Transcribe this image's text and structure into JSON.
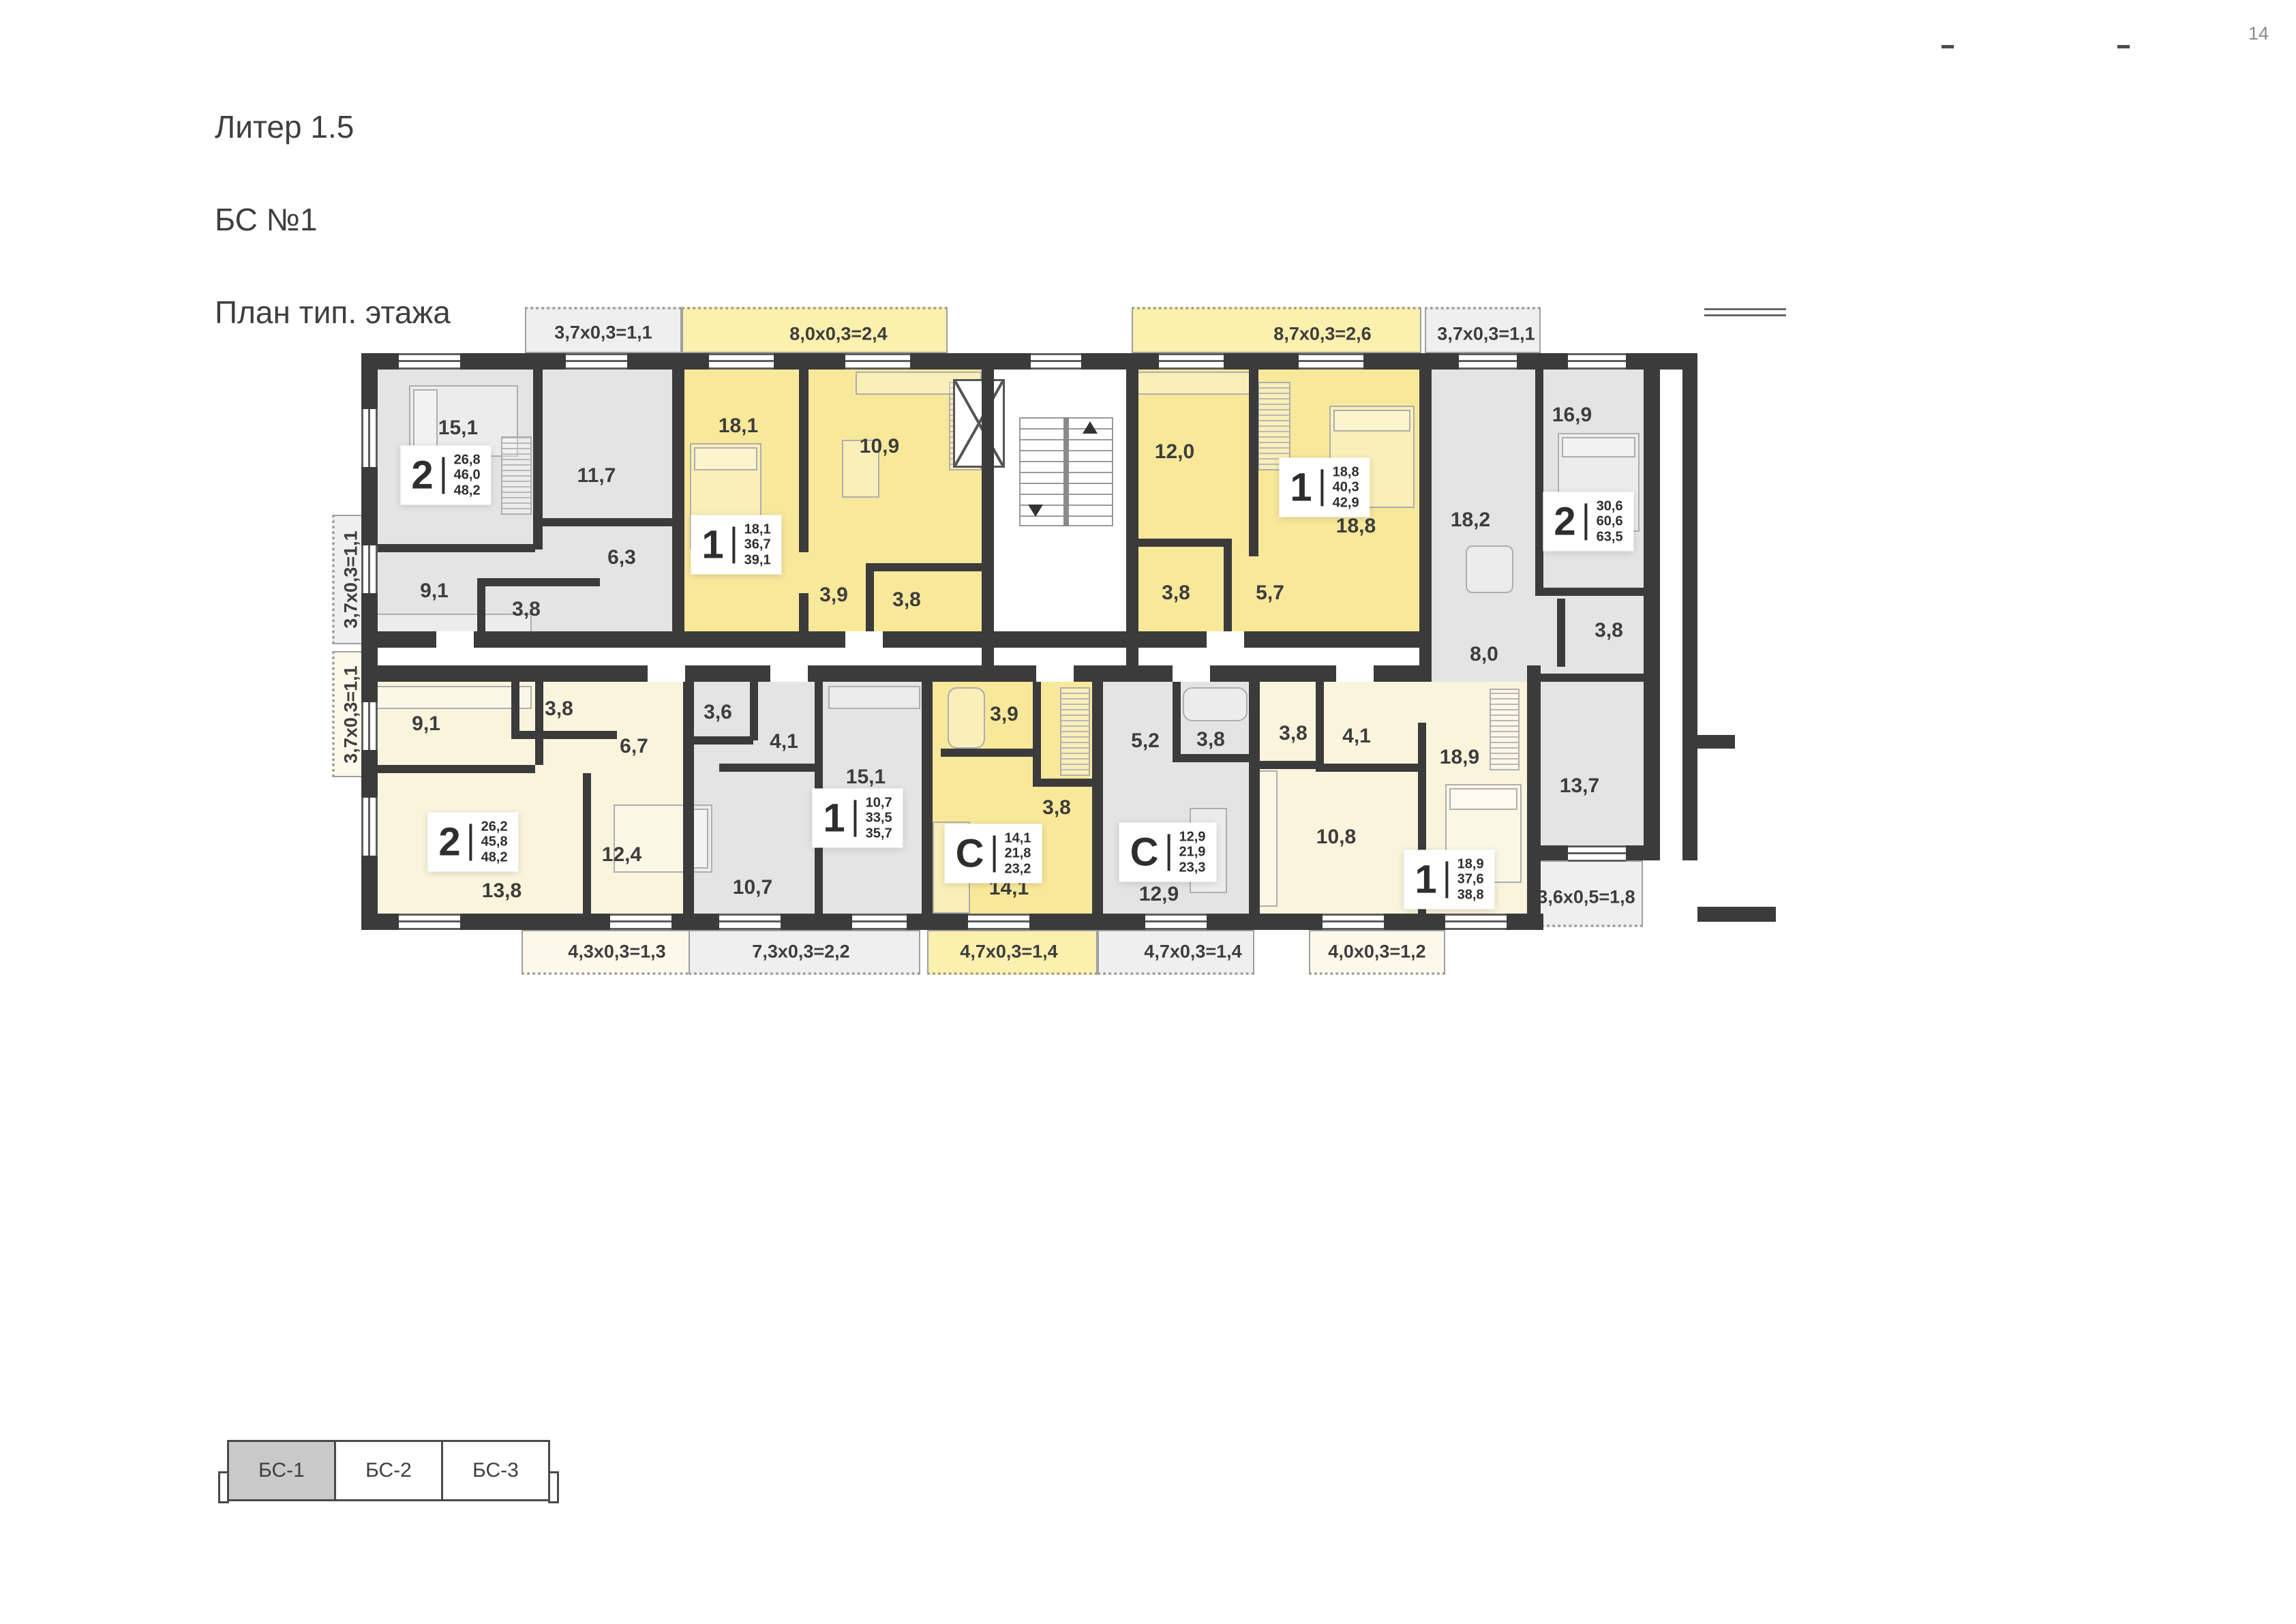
{
  "header": {
    "title_lines": [
      "Литер 1.5",
      "БС №1",
      "План тип. этажа"
    ],
    "page_number": "14"
  },
  "colors": {
    "wall": "#3b3b3b",
    "room_gray": "#e4e4e4",
    "room_yellow": "#f8e89a",
    "room_cream": "#faf4dd",
    "tab_selected": "#c9c9c9"
  },
  "apartments": [
    {
      "id": "A1",
      "type": "2",
      "areas": [
        "26,8",
        "46,0",
        "48,2"
      ],
      "rooms": [
        {
          "area": "15,1"
        },
        {
          "area": "11,7"
        },
        {
          "area": "6,3"
        },
        {
          "area": "9,1"
        },
        {
          "area": "3,8"
        }
      ],
      "balconies": [
        {
          "label": "3,7x0,3=1,1"
        },
        {
          "label": "3,7x0,3=1,1"
        }
      ]
    },
    {
      "id": "A2",
      "type": "1",
      "areas": [
        "18,1",
        "36,7",
        "39,1"
      ],
      "rooms": [
        {
          "area": "18,1"
        },
        {
          "area": "10,9"
        },
        {
          "area": "3,9"
        },
        {
          "area": "3,8"
        }
      ],
      "balconies": [
        {
          "label": "8,0x0,3=2,4"
        }
      ]
    },
    {
      "id": "A3",
      "type": "1",
      "areas": [
        "18,8",
        "40,3",
        "42,9"
      ],
      "rooms": [
        {
          "area": "12,0"
        },
        {
          "area": "18,8"
        },
        {
          "area": "3,8"
        },
        {
          "area": "5,7"
        }
      ],
      "balconies": [
        {
          "label": "8,7x0,3=2,6"
        }
      ]
    },
    {
      "id": "A4",
      "type": "2",
      "areas": [
        "30,6",
        "60,6",
        "63,5"
      ],
      "rooms": [
        {
          "area": "16,9"
        },
        {
          "area": "18,2"
        },
        {
          "area": "8,0"
        },
        {
          "area": "3,8"
        },
        {
          "area": "13,7"
        }
      ],
      "balconies": [
        {
          "label": "3,7x0,3=1,1"
        }
      ]
    },
    {
      "id": "A5",
      "type": "2",
      "areas": [
        "26,2",
        "45,8",
        "48,2"
      ],
      "rooms": [
        {
          "area": "9,1"
        },
        {
          "area": "3,8"
        },
        {
          "area": "6,7"
        },
        {
          "area": "13,8"
        },
        {
          "area": "12,4"
        }
      ],
      "balconies": [
        {
          "label": "3,7x0,3=1,1"
        },
        {
          "label": "4,3x0,3=1,3"
        }
      ]
    },
    {
      "id": "A6",
      "type": "1",
      "areas": [
        "10,7",
        "33,5",
        "35,7"
      ],
      "rooms": [
        {
          "area": "3,6"
        },
        {
          "area": "4,1"
        },
        {
          "area": "15,1"
        },
        {
          "area": "10,7"
        }
      ],
      "balconies": [
        {
          "label": "7,3x0,3=2,2"
        }
      ]
    },
    {
      "id": "A7",
      "type": "С",
      "areas": [
        "14,1",
        "21,8",
        "23,2"
      ],
      "rooms": [
        {
          "area": "3,9"
        },
        {
          "area": "3,8"
        },
        {
          "area": "14,1"
        }
      ],
      "balconies": [
        {
          "label": "4,7x0,3=1,4"
        }
      ]
    },
    {
      "id": "A8",
      "type": "С",
      "areas": [
        "12,9",
        "21,9",
        "23,3"
      ],
      "rooms": [
        {
          "area": "5,2"
        },
        {
          "area": "3,8"
        },
        {
          "area": "12,9"
        }
      ],
      "balconies": [
        {
          "label": "4,7x0,3=1,4"
        }
      ]
    },
    {
      "id": "A9",
      "type": "1",
      "areas": [
        "18,9",
        "37,6",
        "38,8"
      ],
      "rooms": [
        {
          "area": "3,8"
        },
        {
          "area": "4,1"
        },
        {
          "area": "10,8"
        },
        {
          "area": "18,9"
        }
      ],
      "balconies": [
        {
          "label": "4,0x0,3=1,2"
        },
        {
          "label": "3,6x0,5=1,8"
        }
      ]
    }
  ],
  "legend_tabs": [
    {
      "label": "БС-1",
      "active": true
    },
    {
      "label": "БС-2",
      "active": false
    },
    {
      "label": "БС-3",
      "active": false
    }
  ]
}
